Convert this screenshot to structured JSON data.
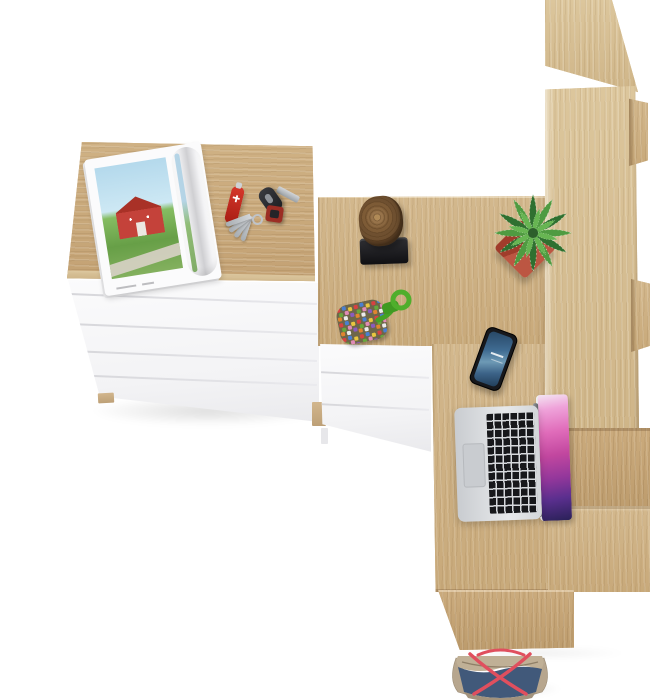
{
  "meta": {
    "scene_title": "Top view of oak and white furniture set with desk accessories",
    "canvas": {
      "width": 650,
      "height": 700
    }
  },
  "palette": {
    "background": "#ffffff",
    "oak": "#cdb289",
    "oak-light": "#d7c094",
    "oak-dark": "#b79a6c",
    "white-furniture": "#f7f7f8",
    "drawer-gap": "#d8d8dc"
  },
  "furniture": {
    "dresser": {
      "label": "white chest of drawers with oak top",
      "drawers": 5
    },
    "desk": {
      "label": "oak corner desk"
    },
    "pedestal": {
      "label": "white under-desk drawer unit",
      "drawers": 3
    },
    "bookcase": {
      "label": "tall oak bookcase with stepped shelves",
      "visible_shelf_edges": 3
    },
    "platform": {
      "label": "lower oak desk return and base panels"
    }
  },
  "items": [
    {
      "id": "magazine",
      "label": "open magazine with red barn landscape photo",
      "colors": {
        "page": "#fbfbfc",
        "sky": "#b4d9ec",
        "grass": "#679f47",
        "barn": "#c4423a"
      }
    },
    {
      "id": "pocket-knife",
      "label": "red pocket knife",
      "colors": {
        "body": "#d6372b"
      }
    },
    {
      "id": "keys",
      "label": "car key with fob, ring, red tag and key bundle",
      "colors": {
        "fob": "#2b2c30",
        "blade": "#b9bcc0",
        "tag": "#9c2d24"
      }
    },
    {
      "id": "wood-stump",
      "label": "decorative wooden stump on black stand",
      "colors": {
        "wood": "#8a6740",
        "stand": "#1a1a1e"
      }
    },
    {
      "id": "beaded-keychain",
      "label": "multicolor beaded patch with green paracord loop",
      "colors": {
        "cord": "#4fae2c",
        "patch": "#6e6649"
      }
    },
    {
      "id": "potted-plant",
      "label": "speckled succulent in red square pot",
      "colors": {
        "pot": "#a03c2b",
        "leaves": "#4f9b41"
      }
    },
    {
      "id": "smartphone",
      "label": "black smartphone with blue lock screen",
      "colors": {
        "body": "#17181c",
        "screen": "#3f6b92"
      }
    },
    {
      "id": "laptop",
      "label": "open silver laptop with purple wallpaper",
      "colors": {
        "body": "#d7d9dc",
        "keys": "#17181b",
        "screen": "#c2479f"
      }
    },
    {
      "id": "tote-bag",
      "label": "blue and taupe tote bag with red straps on floor",
      "colors": {
        "canvas": "#41597a",
        "trim": "#b7a68e",
        "straps": "#e04f5e"
      }
    }
  ]
}
